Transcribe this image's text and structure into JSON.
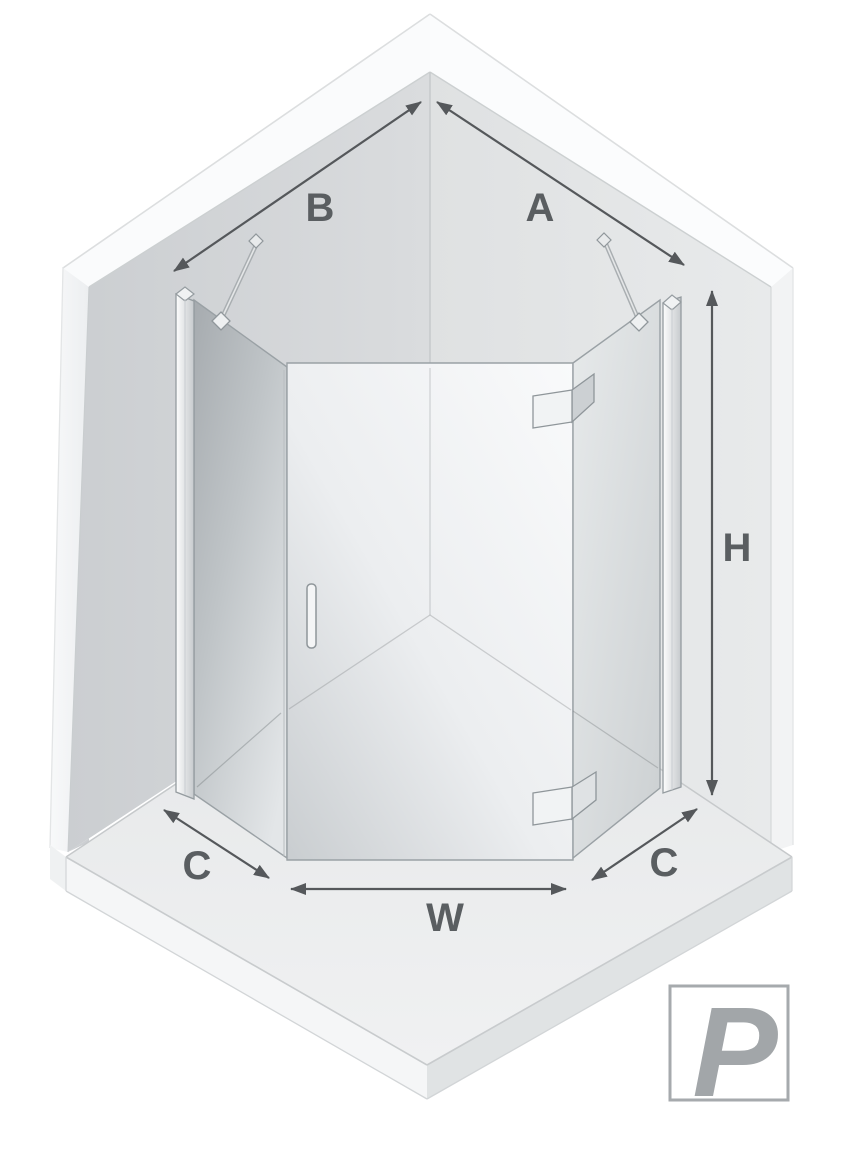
{
  "diagram": {
    "description": "Pentagonal corner shower enclosure - isometric dimension diagram",
    "labels": {
      "left_wall_width": "B",
      "right_wall_width": "A",
      "height": "H",
      "left_corner_cut": "C",
      "front_width": "W",
      "right_corner_cut": "C"
    },
    "logo": {
      "letter": "P"
    },
    "colors": {
      "background": "#ffffff",
      "dimension_text": "#5a5e61",
      "dimension_arrow": "#55585b",
      "wall_left": "#d0d3d5",
      "wall_right": "#e2e4e5",
      "wall_top_edge": "#fafbfc",
      "floor": "#e9ebec",
      "glass_left": "#b0b5b9",
      "glass_door": "#f2f4f5",
      "glass_right": "#dde0e2",
      "frame": "#959ca0",
      "logo_gray": "#a2a6a9"
    }
  }
}
